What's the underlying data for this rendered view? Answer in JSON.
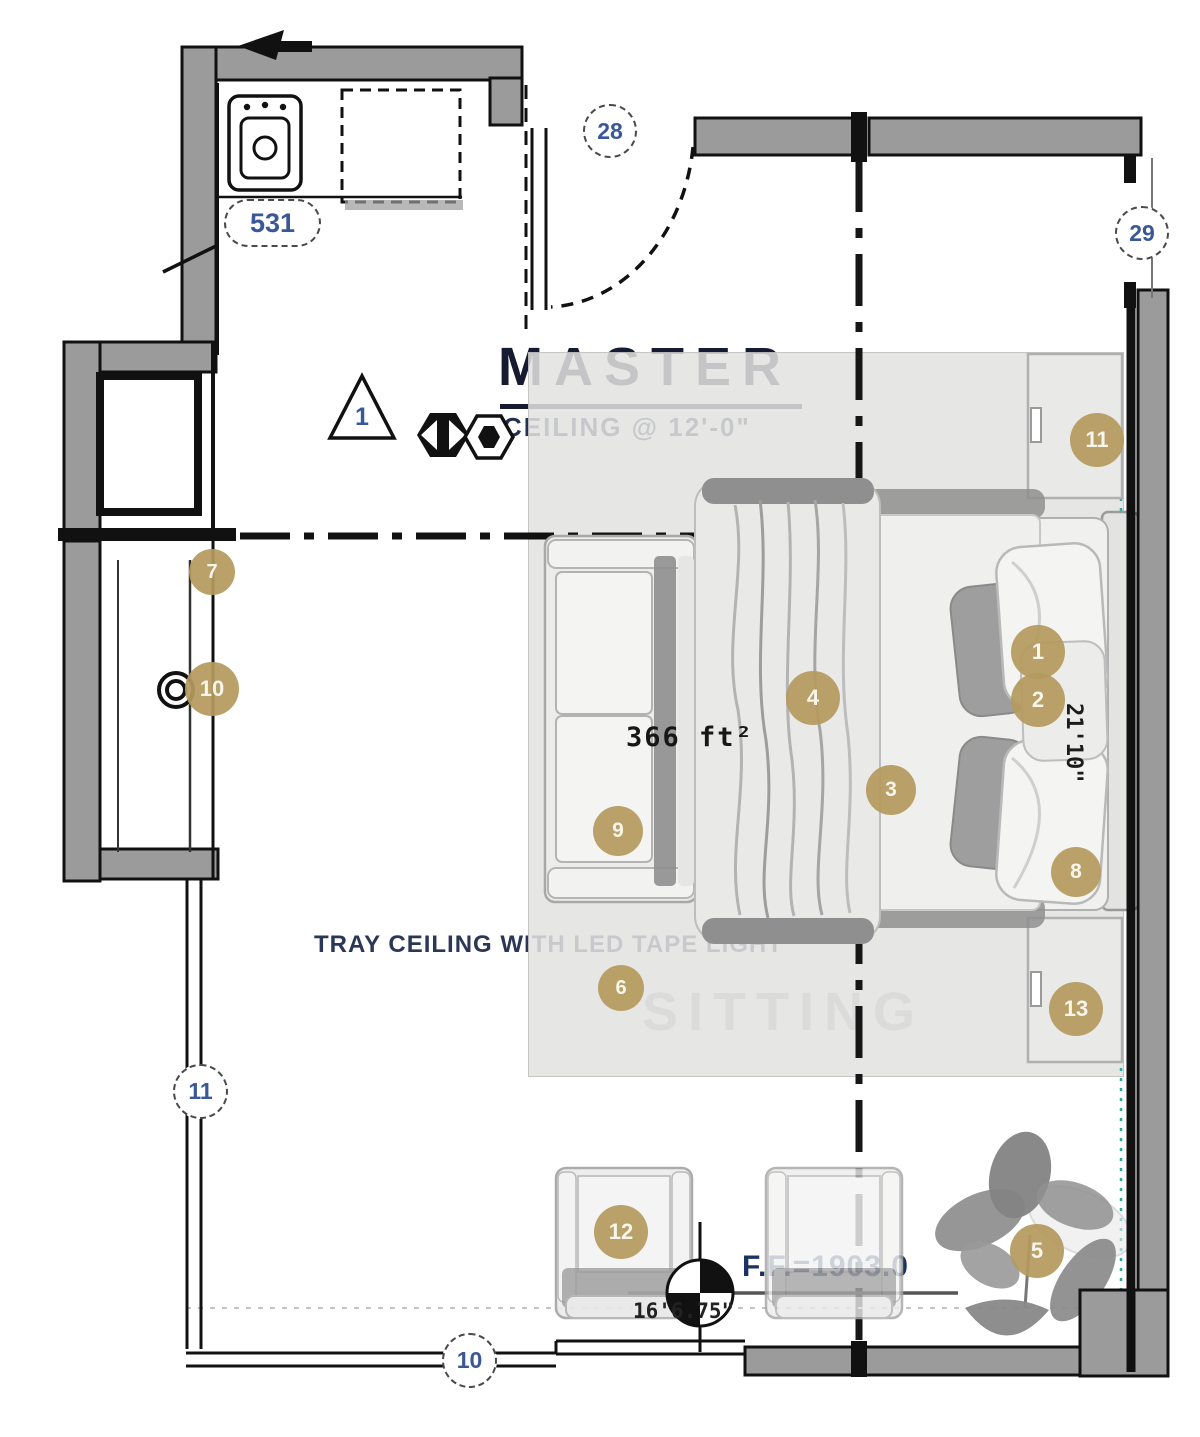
{
  "room": {
    "name": "MASTER",
    "ceiling": "CEILING @ 12'-0\"",
    "area": "366 ft²",
    "tray_note": "TRAY CEILING WITH LED TAPE LIGHT",
    "sitting": "SITTING",
    "floor_elevation": "F.F.=1903.0",
    "dim_height": "21'10\"",
    "dim_width": "16'6.75\""
  },
  "tags": {
    "door_tag": "28",
    "window_tag_right": "29",
    "window_tag_left": "11",
    "window_tag_bottom": "10",
    "keynote": "531",
    "revision": "1"
  },
  "markers": {
    "m1": "1",
    "m2": "2",
    "m3": "3",
    "m4": "4",
    "m5": "5",
    "m6": "6",
    "m7": "7",
    "m8": "8",
    "m9": "9",
    "m10": "10",
    "m11": "11",
    "m12": "12",
    "m13": "13"
  },
  "colors": {
    "marker_gold": "#b49a5e",
    "label_navy": "#1d3260",
    "tag_blue": "#3a5796",
    "survey_teal": "#2fa99a"
  }
}
